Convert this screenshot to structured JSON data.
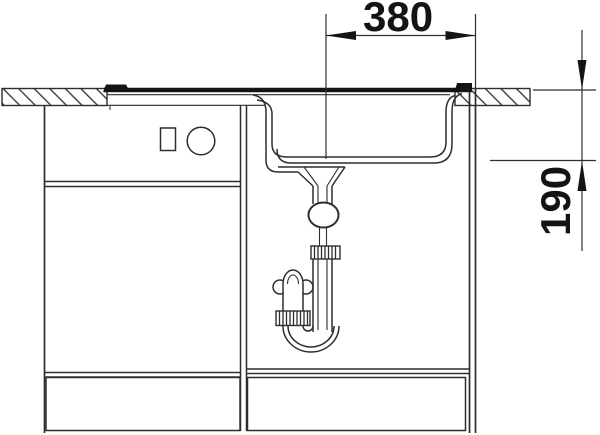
{
  "diagram": {
    "subject": "Kitchen sink and base cabinet cross-section with drain siphon",
    "dimensions": {
      "horizontal": {
        "label": "380"
      },
      "vertical": {
        "label": "190"
      }
    },
    "colors": {
      "ink": "#2e2e2e",
      "ink_dark": "#141414",
      "background": "#ffffff"
    }
  }
}
